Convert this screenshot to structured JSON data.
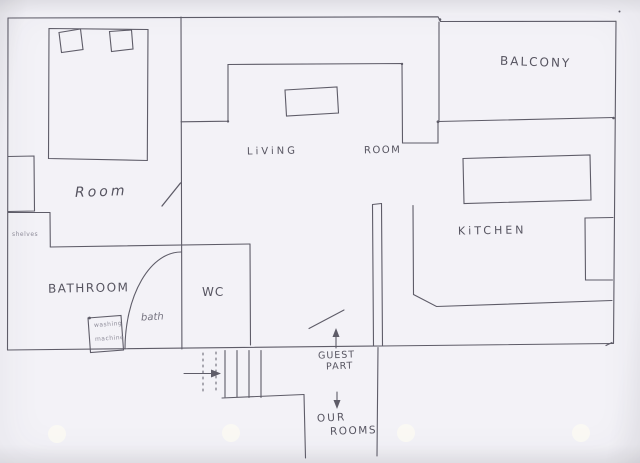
{
  "drawing": {
    "kind": "hand-drawn apartment floor plan sketch",
    "ink_color": "#5e5c68",
    "paper_color": "#f3f2f7",
    "labels": {
      "room": "Room",
      "living_room_word1": "LiViNG",
      "living_room_word2": "ROOM",
      "balcony": "BALCONY",
      "kitchen": "KiTCHEN",
      "bathroom": "BATHROOM",
      "wc": "WC",
      "bath": "bath",
      "shelves": "shelves",
      "washing_machine_line1": "washing",
      "washing_machine_line2": "machine",
      "guest_part_line1": "GUEST",
      "guest_part_line2": "PART",
      "our_rooms_line1": "OUR",
      "our_rooms_line2": "ROOMS"
    },
    "annotations": {
      "entrance_arrow": "right-arrow at entry door",
      "guest_part_arrow": "up-arrow",
      "our_rooms_arrow": "down-arrow",
      "hole_punches": 4
    }
  }
}
